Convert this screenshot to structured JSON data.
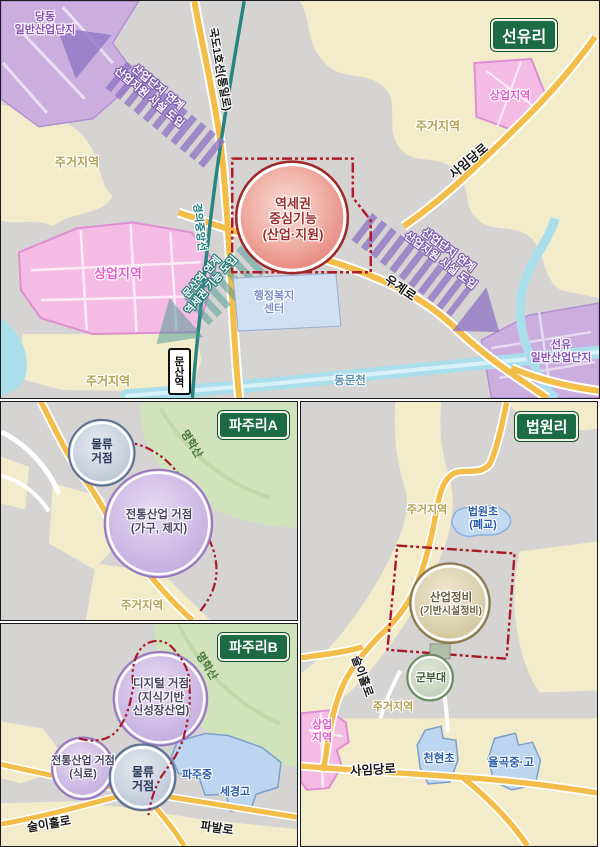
{
  "colors": {
    "panel_title_bg": "#1d6b45",
    "road_yellow": "#f3bd4a",
    "railway_teal": "#2a8480",
    "boundary_red": "#b01a2a",
    "arrow_purple": "#8f76c4",
    "arrow_teal": "#4a9a96",
    "zone_purple": "#cbaede",
    "zone_pink": "#f4bce4",
    "zone_cream": "#f2ecca",
    "zone_green": "#d0e3bc",
    "water_blue": "#aadeea",
    "school_blue": "#bdd5ee"
  },
  "panels": {
    "seonyuri": {
      "title": "선유리",
      "zones": {
        "dangdong_line1": "당동",
        "dangdong_line2": "일반산업단지",
        "jugeo_left": "주거지역",
        "sangeop_left": "상업지역",
        "jugeo_bottom": "주거지역",
        "jugeo_topright": "주거지역",
        "sangeop_topright": "상업지역",
        "seonyu_line1": "선유",
        "seonyu_line2": "일반산업단지",
        "welfare_line1": "행정복지",
        "welfare_line2": "센터"
      },
      "roads": {
        "gukdo1": "국도1호선(통일로)",
        "saimdang": "사임당로",
        "ugye": "우계로",
        "railway": "경의중앙선",
        "stream": "동문천"
      },
      "station": "문산역",
      "arrows": {
        "industry_line1": "산업단지 연계",
        "industry_line2": "산업지원 시설 도입",
        "station_line1": "문산역 연계",
        "station_line2": "역세권 기능 도입"
      },
      "core": {
        "line1": "역세권",
        "line2": "중심기능",
        "line3": "(산업·지원)"
      }
    },
    "pajuriA": {
      "title": "파주리A",
      "mountain": "명학산",
      "hub_logistics_line1": "물류",
      "hub_logistics_line2": "거점",
      "hub_traditional_line1": "전통산업 거점",
      "hub_traditional_line2": "(가구, 제지)",
      "jugeo": "주거지역"
    },
    "pajuriB": {
      "title": "파주리B",
      "mountain": "명학산",
      "hub_digital_line1": "디지털 거점",
      "hub_digital_line2": "(지식기반",
      "hub_digital_line3": "신성장산업)",
      "hub_traditional_line1": "전통산업 거점",
      "hub_traditional_line2": "(식료)",
      "hub_logistics_line1": "물류",
      "hub_logistics_line2": "거점",
      "school_paju": "파주중",
      "school_segyeong": "세경고",
      "road_surihol": "술이홀로",
      "road_pabal": "파발로"
    },
    "beobwonri": {
      "title": "법원리",
      "jugeo_top": "주거지역",
      "jugeo_mid": "주거지역",
      "school_closed_line1": "법원초",
      "school_closed_line2": "(폐교)",
      "core_line1": "산업정비",
      "core_line2": "(기반시설정비)",
      "military": "군부대",
      "sangeop_line1": "상업",
      "sangeop_line2": "지역",
      "school_cheonhyeon": "천현초",
      "school_yulgok": "율곡중·고",
      "road_surihol": "술이홀로",
      "road_saimdang": "사임당로"
    }
  }
}
